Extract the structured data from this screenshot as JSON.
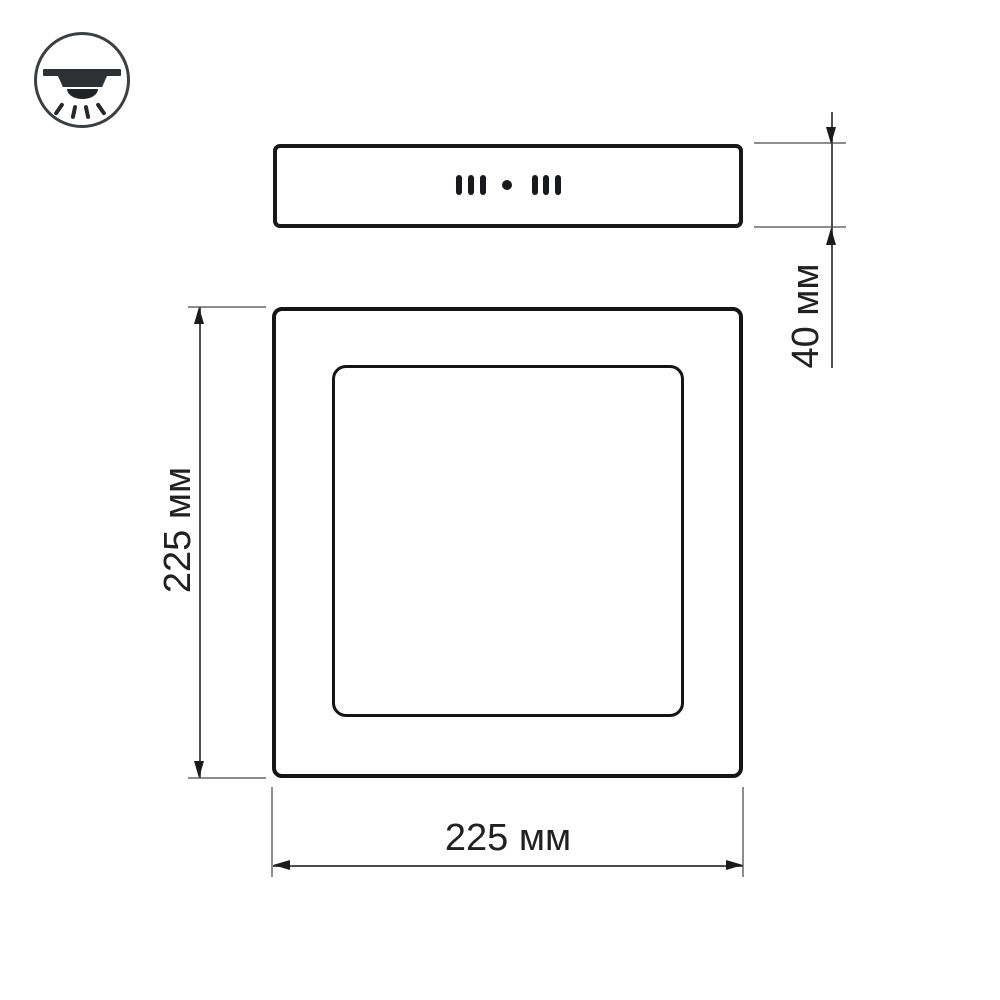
{
  "drawing": {
    "background": "#ffffff",
    "outline_color": "#141414",
    "dimension_line_color": "#4c4c4c",
    "extension_line_color": "#8d8d8d",
    "text_color": "#212121",
    "icon": {
      "name": "surface-mounted-downlight-icon",
      "rays": 4
    },
    "side_view": {
      "slot_groups": 2,
      "slots_per_group": 3,
      "center_dot": true
    },
    "front_view": {
      "outer_frame": true,
      "inner_panel": true
    },
    "dimensions": {
      "depth": {
        "label": "40 мм",
        "orientation": "vertical"
      },
      "height": {
        "label": "225 мм",
        "orientation": "vertical"
      },
      "width": {
        "label": "225 мм",
        "orientation": "horizontal"
      }
    }
  }
}
